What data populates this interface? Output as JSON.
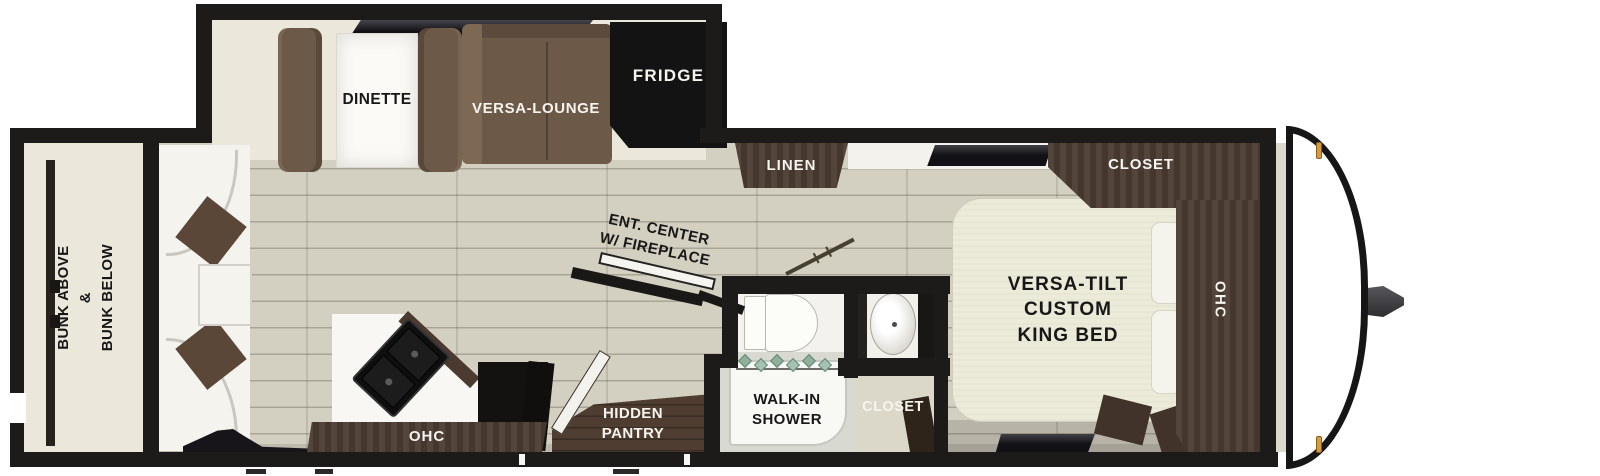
{
  "figure": "travel-trailer-floorplan-top-view",
  "labels": {
    "bunk": [
      "BUNK ABOVE",
      "&",
      "BUNK BELOW"
    ],
    "dinette": "DINETTE",
    "versa_lounge": "VERSA-LOUNGE",
    "fridge": "FRIDGE",
    "linen": "LINEN",
    "ent_center": [
      "ENT. CENTER",
      "W/ FIREPLACE"
    ],
    "shower": [
      "WALK-IN",
      "SHOWER"
    ],
    "pantry": [
      "HIDDEN",
      "PANTRY"
    ],
    "closet_bath": "CLOSET",
    "closet_bedroom": "CLOSET",
    "bed": [
      "VERSA-TILT",
      "CUSTOM",
      "KING BED"
    ],
    "ohc_kitchen": "OHC",
    "ohc_bedroom": "OHC"
  },
  "colors": {
    "wall": "#1d1b19",
    "floor_wood": "#d3cfc1",
    "slide_floor": "#ebe8db",
    "sofa_brown": "#6d5947",
    "cabinet_brown": "#4a3a31",
    "dark_wood_floor": "#4e3d30",
    "counter_white": "#f8f7f3",
    "bed_cream": "#ecead8",
    "appliance_black": "#131313",
    "shower_glass_teal": "#8fae9c",
    "marker_light_amber": "#d99a3e"
  }
}
